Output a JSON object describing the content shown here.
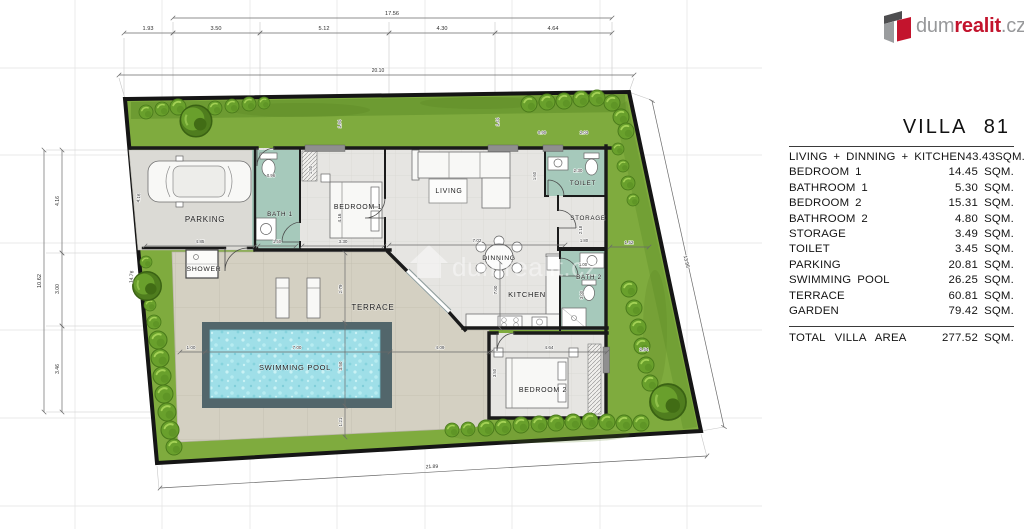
{
  "title": "VILLA 81",
  "logo": {
    "dum": "dum",
    "realit": "realit",
    "cz": ".cz"
  },
  "watermark": "dumrealit.cz",
  "colors": {
    "brand_red": "#c3142d",
    "logo_gray": "#97989a",
    "garden_green": "#7fab3e",
    "hedge_green": "#5b8c25",
    "pool_water": "#9fdfe8",
    "wet_room_teal": "#a6c9bb",
    "terrace_beige": "#d4d0c2",
    "floor_gray": "#e6e5e2",
    "wall_black": "#1a1a1a"
  },
  "table": {
    "rows": [
      {
        "label": "LIVING + DINNING + KITCHEN",
        "value": "43.43",
        "unit": "SQM."
      },
      {
        "label": "BEDROOM 1",
        "value": "14.45",
        "unit": "SQM."
      },
      {
        "label": "BATHROOM 1",
        "value": "5.30",
        "unit": "SQM."
      },
      {
        "label": "BEDROOM 2",
        "value": "15.31",
        "unit": "SQM."
      },
      {
        "label": "BATHROOM 2",
        "value": "4.80",
        "unit": "SQM."
      },
      {
        "label": "STORAGE",
        "value": "3.49",
        "unit": "SQM."
      },
      {
        "label": "TOILET",
        "value": "3.45",
        "unit": "SQM."
      },
      {
        "label": "PARKING",
        "value": "20.81",
        "unit": "SQM."
      },
      {
        "label": "SWIMMING POOL",
        "value": "26.25",
        "unit": "SQM."
      },
      {
        "label": "TERRACE",
        "value": "60.81",
        "unit": "SQM."
      },
      {
        "label": "GARDEN",
        "value": "79.42",
        "unit": "SQM."
      }
    ],
    "total": {
      "label": "TOTAL VILLA AREA",
      "value": "277.52",
      "unit": "SQM."
    }
  },
  "plan": {
    "rooms": [
      {
        "name": "PARKING",
        "x": 205,
        "y": 222,
        "fs": 8
      },
      {
        "name": "BATH 1",
        "x": 280,
        "y": 216,
        "fs": 6.3
      },
      {
        "name": "BEDROOM 1",
        "x": 358,
        "y": 209,
        "fs": 7
      },
      {
        "name": "LIVING",
        "x": 449,
        "y": 193,
        "fs": 7
      },
      {
        "name": "TOILET",
        "x": 583,
        "y": 185,
        "fs": 6.3
      },
      {
        "name": "STORAGE",
        "x": 588,
        "y": 220,
        "fs": 6.3
      },
      {
        "name": "SHOWER",
        "x": 204,
        "y": 271,
        "fs": 6.8
      },
      {
        "name": "TERRACE",
        "x": 373,
        "y": 310,
        "fs": 8
      },
      {
        "name": "SWIMMING POOL",
        "x": 295,
        "y": 370,
        "fs": 7.5
      },
      {
        "name": "DINNING",
        "x": 499,
        "y": 260,
        "fs": 6.8
      },
      {
        "name": "KITCHEN",
        "x": 527,
        "y": 297,
        "fs": 7.5
      },
      {
        "name": "BATH 2",
        "x": 589,
        "y": 279,
        "fs": 6.3
      },
      {
        "name": "BEDROOM 2",
        "x": 543,
        "y": 392,
        "fs": 7
      }
    ],
    "dimensions": [
      {
        "t": "17.56",
        "x1": 173,
        "y1": 18,
        "x2": 612,
        "y2": 18,
        "lx": 392,
        "ly": 15
      },
      {
        "t": "1.93",
        "x1": 124,
        "y1": 33,
        "x2": 173,
        "y2": 33,
        "lx": 148,
        "ly": 30
      },
      {
        "t": "3.50",
        "x1": 173,
        "y1": 33,
        "x2": 260,
        "y2": 33,
        "lx": 216,
        "ly": 30
      },
      {
        "t": "5.12",
        "x1": 260,
        "y1": 33,
        "x2": 389,
        "y2": 33,
        "lx": 324,
        "ly": 30
      },
      {
        "t": "4.30",
        "x1": 389,
        "y1": 33,
        "x2": 495,
        "y2": 33,
        "lx": 442,
        "ly": 30
      },
      {
        "t": "4.64",
        "x1": 495,
        "y1": 33,
        "x2": 612,
        "y2": 33,
        "lx": 553,
        "ly": 30
      },
      {
        "t": "20.10",
        "x1": 119,
        "y1": 75,
        "x2": 634,
        "y2": 75,
        "lx": 378,
        "ly": 72,
        "fs": 5
      },
      {
        "t": "10.62",
        "x1": 44,
        "y1": 150,
        "x2": 44,
        "y2": 412,
        "lx": 41,
        "ly": 281,
        "rot": -90
      },
      {
        "t": "4.16",
        "x1": 62,
        "y1": 150,
        "x2": 62,
        "y2": 253,
        "lx": 59,
        "ly": 201,
        "rot": -90,
        "fs": 5
      },
      {
        "t": "3.00",
        "x1": 62,
        "y1": 253,
        "x2": 62,
        "y2": 326,
        "lx": 59,
        "ly": 289,
        "rot": -90,
        "fs": 5
      },
      {
        "t": "3.46",
        "x1": 62,
        "y1": 326,
        "x2": 62,
        "y2": 412,
        "lx": 59,
        "ly": 369,
        "rot": -90,
        "fs": 5
      },
      {
        "t": "14.76",
        "lx": 133,
        "ly": 277,
        "rot": -85,
        "fs": 5
      },
      {
        "t": "13.95",
        "x1": 652,
        "y1": 101,
        "x2": 724,
        "y2": 427,
        "lx": 685,
        "ly": 262,
        "rot": 77,
        "fs": 5
      },
      {
        "t": "21.89",
        "x1": 160,
        "y1": 488,
        "x2": 707,
        "y2": 456,
        "lx": 432,
        "ly": 468,
        "rot": -3,
        "fs": 5
      },
      {
        "t": "1.52",
        "x1": 610,
        "y1": 247,
        "x2": 649,
        "y2": 247,
        "lx": 629,
        "ly": 244,
        "fs": 4.6
      },
      {
        "t": "2.54",
        "lx": 644,
        "ly": 351,
        "fs": 4.6
      },
      {
        "t": "1.00",
        "x1": 180,
        "y1": 352,
        "x2": 205,
        "y2": 352,
        "lx": 191,
        "ly": 349,
        "fs": 4.6
      },
      {
        "t": "7.00",
        "x1": 205,
        "y1": 352,
        "x2": 390,
        "y2": 352,
        "lx": 297,
        "ly": 349,
        "fs": 4.6
      },
      {
        "t": "4.09",
        "x1": 390,
        "y1": 352,
        "x2": 489,
        "y2": 352,
        "lx": 440,
        "ly": 349,
        "fs": 4.6
      },
      {
        "t": "2.79",
        "x1": 345,
        "y1": 253,
        "x2": 345,
        "y2": 323,
        "lx": 342,
        "ly": 289,
        "rot": -90,
        "fs": 4.6
      },
      {
        "t": "3.50",
        "x1": 345,
        "y1": 323,
        "x2": 345,
        "y2": 406,
        "lx": 342,
        "ly": 366,
        "rot": -90,
        "fs": 4.6
      },
      {
        "t": "1.21",
        "x1": 345,
        "y1": 406,
        "x2": 345,
        "y2": 437,
        "lx": 342,
        "ly": 422,
        "rot": -90,
        "fs": 4.6
      },
      {
        "t": "4.16",
        "lx": 140,
        "ly": 198,
        "rot": -86,
        "fs": 4.6
      },
      {
        "t": "4.85",
        "x1": 145,
        "y1": 246,
        "x2": 255,
        "y2": 246,
        "lx": 200,
        "ly": 243,
        "fs": 4.6
      },
      {
        "t": "0.96",
        "lx": 271,
        "ly": 177,
        "fs": 4.2
      },
      {
        "t": "1.50",
        "x1": 258,
        "y1": 246,
        "x2": 296,
        "y2": 246,
        "lx": 277,
        "ly": 243,
        "fs": 4.2
      },
      {
        "t": "1.50",
        "lx": 312,
        "ly": 170,
        "rot": -90,
        "fs": 4.2
      },
      {
        "t": "4.16",
        "lx": 341,
        "ly": 218,
        "rot": -90,
        "fs": 4.6
      },
      {
        "t": "3.30",
        "x1": 302,
        "y1": 246,
        "x2": 384,
        "y2": 246,
        "lx": 343,
        "ly": 243,
        "fs": 4.6
      },
      {
        "t": "1.94",
        "lx": 341,
        "ly": 124,
        "rot": -90,
        "fs": 4.2
      },
      {
        "t": "1.44",
        "lx": 499,
        "ly": 122,
        "rot": -90,
        "fs": 4.2
      },
      {
        "t": "0.90",
        "lx": 542,
        "ly": 134,
        "fs": 4.2
      },
      {
        "t": "2.03",
        "lx": 584,
        "ly": 134,
        "fs": 4.2
      },
      {
        "t": "1.60",
        "lx": 536,
        "ly": 176,
        "rot": -90,
        "fs": 4.2
      },
      {
        "t": "2.30",
        "lx": 578,
        "ly": 172,
        "fs": 4.6
      },
      {
        "t": "2.18",
        "lx": 582,
        "ly": 230,
        "rot": -90,
        "fs": 4.2
      },
      {
        "t": "1.80",
        "lx": 584,
        "ly": 242,
        "fs": 4.2
      },
      {
        "t": "1.00",
        "lx": 583,
        "ly": 266,
        "fs": 4.2
      },
      {
        "t": "3.00",
        "lx": 583,
        "ly": 295,
        "rot": -90,
        "fs": 4.2
      },
      {
        "t": "7.02",
        "x1": 389,
        "y1": 245,
        "x2": 565,
        "y2": 245,
        "lx": 477,
        "ly": 242,
        "fs": 4.6
      },
      {
        "t": "7.00",
        "x1": 500,
        "y1": 262,
        "x2": 500,
        "y2": 328,
        "lx": 497,
        "ly": 290,
        "rot": -90,
        "fs": 4.6
      },
      {
        "t": "4.64",
        "x1": 491,
        "y1": 352,
        "x2": 607,
        "y2": 352,
        "lx": 549,
        "ly": 349,
        "fs": 4.6
      },
      {
        "t": "3.50",
        "lx": 496,
        "ly": 373,
        "rot": -90,
        "fs": 4.2
      }
    ]
  }
}
